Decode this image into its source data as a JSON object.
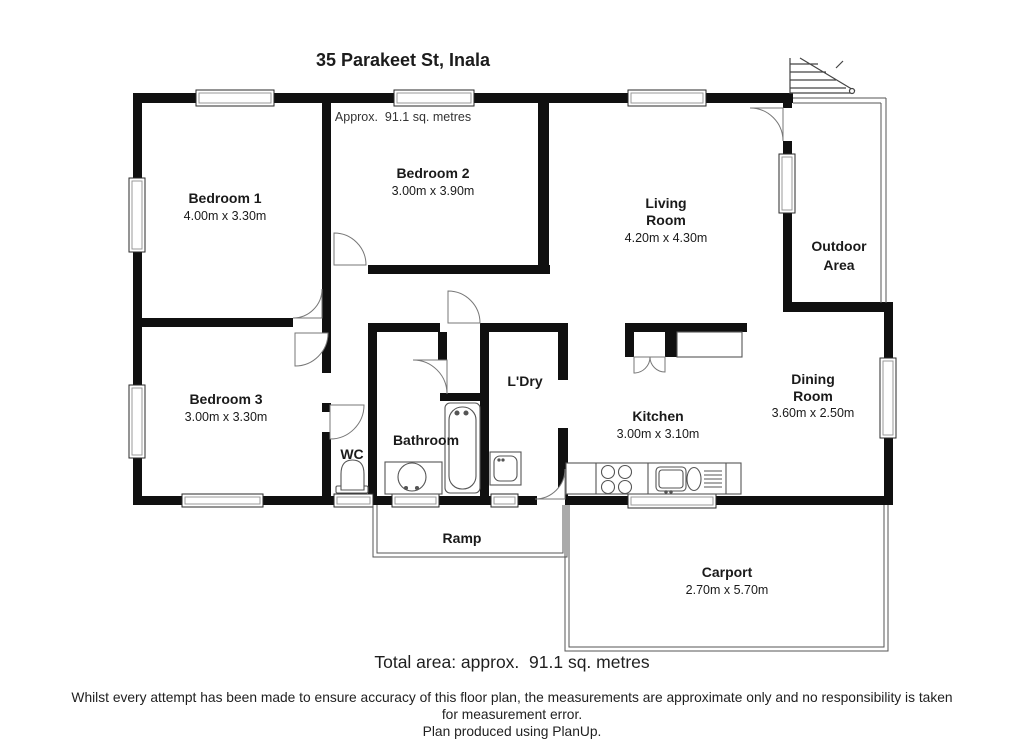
{
  "header": {
    "title": "35 Parakeet St, Inala",
    "subtitle": "Approx.  91.1 sq. metres"
  },
  "rooms": {
    "bedroom1": {
      "name": "Bedroom 1",
      "dims": "4.00m x 3.30m"
    },
    "bedroom2": {
      "name": "Bedroom 2",
      "dims": "3.00m x 3.90m"
    },
    "living": {
      "line1": "Living",
      "line2": "Room",
      "dims": "4.20m x 4.30m"
    },
    "outdoor": {
      "line1": "Outdoor",
      "line2": "Area"
    },
    "bedroom3": {
      "name": "Bedroom 3",
      "dims": "3.00m x 3.30m"
    },
    "wc": {
      "name": "WC"
    },
    "bathroom": {
      "name": "Bathroom"
    },
    "laundry": {
      "name": "L'Dry"
    },
    "kitchen": {
      "name": "Kitchen",
      "dims": "3.00m x 3.10m"
    },
    "dining": {
      "line1": "Dining",
      "line2": "Room",
      "dims": "3.60m x 2.50m"
    },
    "ramp": {
      "name": "Ramp"
    },
    "carport": {
      "name": "Carport",
      "dims": "2.70m x 5.70m"
    }
  },
  "footer": {
    "total_area": "Total area: approx.  91.1 sq. metres",
    "disclaimer_line1": "Whilst every attempt has been made to ensure accuracy of this floor plan, the measurements are approximate only and no responsibility is taken",
    "disclaimer_line2": "for measurement error.",
    "credit": "Plan produced using PlanUp."
  },
  "colors": {
    "wall": "#101010",
    "thin_line": "#555555",
    "text": "#1a1a1a"
  }
}
